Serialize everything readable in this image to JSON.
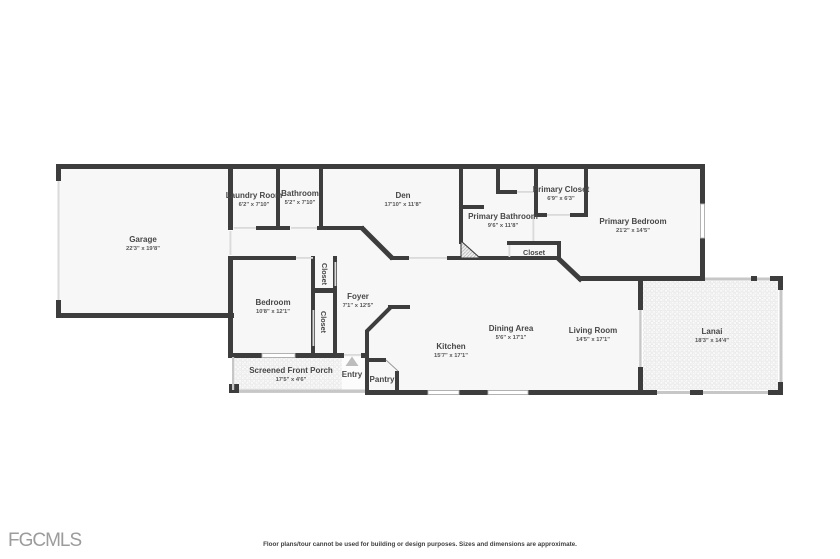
{
  "floor_plan": {
    "wall_color": "#3d3d3d",
    "screen_wall_color": "#c7c7c7",
    "door_opening_color": "#dadada",
    "floor_color": "#f7f7f7",
    "label_color": "#474747",
    "rooms": [
      {
        "id": "garage",
        "name": "Garage",
        "dims": "22'3\" x 19'8\""
      },
      {
        "id": "laundry-room",
        "name": "Laundry Room",
        "dims": "6'2\" x 7'10\""
      },
      {
        "id": "bathroom",
        "name": "Bathroom",
        "dims": "5'2\" x 7'10\""
      },
      {
        "id": "den",
        "name": "Den",
        "dims": "17'10\" x 11'8\""
      },
      {
        "id": "primary-closet",
        "name": "Primary Closet",
        "dims": "6'9\" x 6'3\""
      },
      {
        "id": "primary-bathroom",
        "name": "Primary Bathroom",
        "dims": "9'6\" x 11'8\""
      },
      {
        "id": "primary-bedroom",
        "name": "Primary Bedroom",
        "dims": "21'2\" x 14'5\""
      },
      {
        "id": "closet-primary",
        "name": "Closet",
        "dims": ""
      },
      {
        "id": "bedroom",
        "name": "Bedroom",
        "dims": "10'8\" x 12'1\""
      },
      {
        "id": "foyer",
        "name": "Foyer",
        "dims": "7'1\" x 12'5\""
      },
      {
        "id": "closet-upper",
        "name": "Closet",
        "dims": ""
      },
      {
        "id": "closet-lower",
        "name": "Closet",
        "dims": ""
      },
      {
        "id": "dining-area",
        "name": "Dining Area",
        "dims": "5'6\" x 17'1\""
      },
      {
        "id": "living-room",
        "name": "Living Room",
        "dims": "14'5\" x 17'1\""
      },
      {
        "id": "kitchen",
        "name": "Kitchen",
        "dims": "15'7\" x 17'1\""
      },
      {
        "id": "lanai",
        "name": "Lanai",
        "dims": "18'3\" x 14'4\""
      },
      {
        "id": "screened-front-porch",
        "name": "Screened Front Porch",
        "dims": "17'5\" x 4'6\""
      },
      {
        "id": "entry",
        "name": "Entry",
        "dims": ""
      },
      {
        "id": "pantry",
        "name": "Pantry",
        "dims": ""
      }
    ]
  },
  "footer": {
    "logo": "FGCMLS",
    "disclaimer": "Floor plans/tour cannot be used for building or design purposes. Sizes and dimensions are approximate."
  }
}
